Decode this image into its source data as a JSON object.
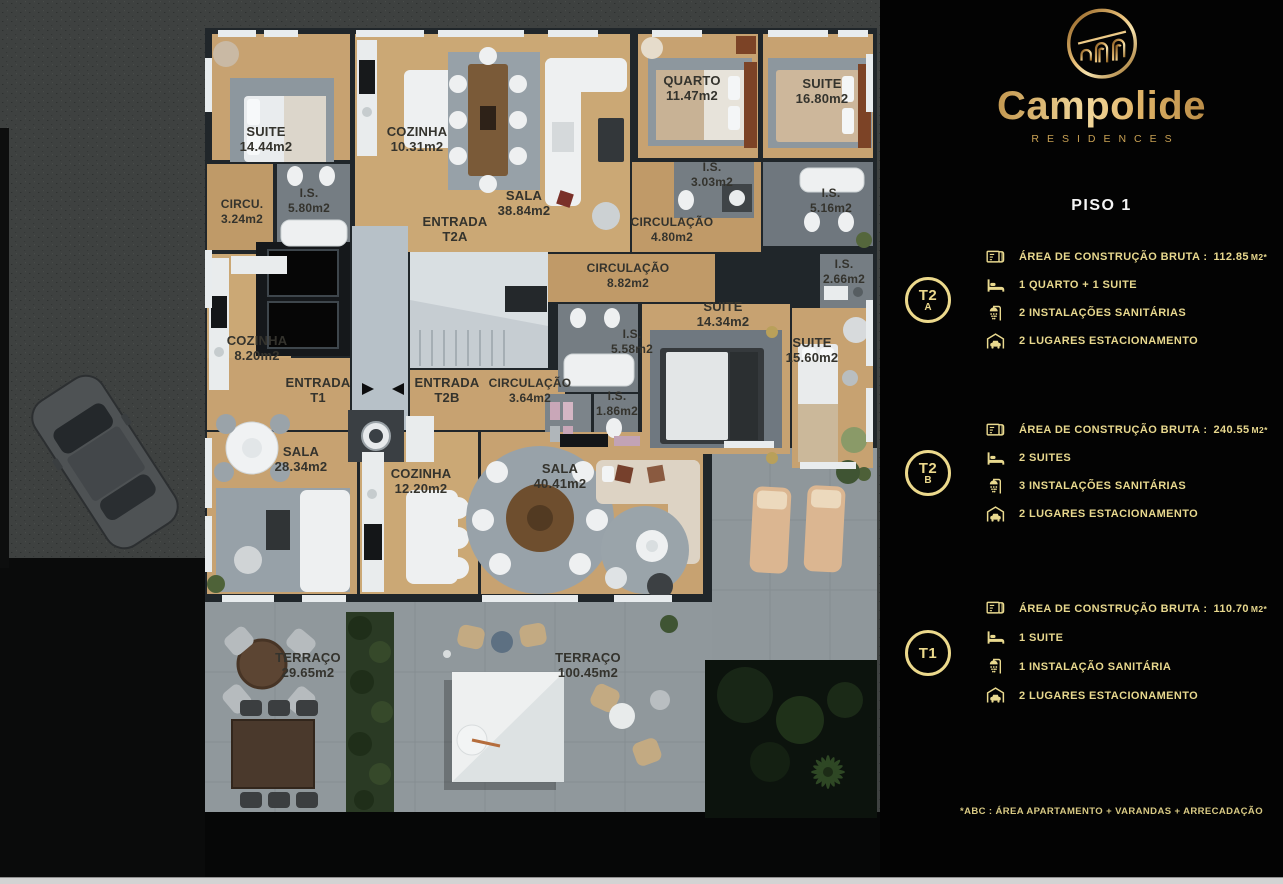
{
  "plan": {
    "rooms": [
      {
        "name": "SUITE",
        "area": "14.44m2"
      },
      {
        "name": "COZINHA",
        "area": "10.31m2"
      },
      {
        "name": "SALA",
        "area": "38.84m2"
      },
      {
        "name": "I.S.",
        "area": "5.80m2"
      },
      {
        "name": "CIRCU.",
        "area": "3.24m2"
      },
      {
        "name": "ENTRADA",
        "area": "T2A"
      },
      {
        "name": "CIRCULAÇÃO",
        "area": "4.80m2"
      },
      {
        "name": "QUARTO",
        "area": "11.47m2"
      },
      {
        "name": "SUITE",
        "area": "16.80m2"
      },
      {
        "name": "I.S.",
        "area": "3.03m2"
      },
      {
        "name": "I.S.",
        "area": "5.16m2"
      },
      {
        "name": "CIRCULAÇÃO",
        "area": "8.82m2"
      },
      {
        "name": "I.S.",
        "area": "2.66m2"
      },
      {
        "name": "SUITE",
        "area": "14.34m2"
      },
      {
        "name": "I.S.",
        "area": "5.58m2"
      },
      {
        "name": "SUITE",
        "area": "15.60m2"
      },
      {
        "name": "I.S.",
        "area": "1.86m2"
      },
      {
        "name": "COZINHA",
        "area": "8.20m2"
      },
      {
        "name": "ENTRADA",
        "area": "T1"
      },
      {
        "name": "ENTRADA",
        "area": "T2B"
      },
      {
        "name": "CIRCULAÇÃO",
        "area": "3.64m2"
      },
      {
        "name": "SALA",
        "area": "28.34m2"
      },
      {
        "name": "COZINHA",
        "area": "12.20m2"
      },
      {
        "name": "SALA",
        "area": "40.41m2"
      },
      {
        "name": "TERRAÇO",
        "area": "29.65m2"
      },
      {
        "name": "TERRAÇO",
        "area": "100.45m2"
      }
    ]
  },
  "panel": {
    "brand": "Campolide",
    "brand_sub": "RESIDENCES",
    "floor_title": "PISO 1",
    "units": [
      {
        "badge_line1": "T2",
        "badge_line2": "A",
        "area_label": "ÁREA DE CONSTRUÇÃO BRUTA :",
        "area_value": "112.85",
        "area_unit": "M2*",
        "features": [
          "1 QUARTO + 1 SUITE",
          "2 INSTALAÇÕES SANITÁRIAS",
          "2 LUGARES ESTACIONAMENTO"
        ]
      },
      {
        "badge_line1": "T2",
        "badge_line2": "B",
        "area_label": "ÁREA DE CONSTRUÇÃO BRUTA :",
        "area_value": "240.55",
        "area_unit": "M2*",
        "features": [
          "2 SUITES",
          "3 INSTALAÇÕES SANITÁRIAS",
          "2 LUGARES ESTACIONAMENTO"
        ]
      },
      {
        "badge_line1": "T1",
        "badge_line2": "",
        "area_label": "ÁREA DE CONSTRUÇÃO BRUTA :",
        "area_value": "110.70",
        "area_unit": "M2*",
        "features": [
          "1 SUITE",
          "1 INSTALAÇÃO SANITÁRIA",
          "2 LUGARES ESTACIONAMENTO"
        ]
      }
    ],
    "footnote": "*ABC :  ÁREA APARTAMENTO + VARANDAS + ARRECADAÇÃO",
    "colors": {
      "gold": "#e8d88e",
      "gold_dark": "#b9862f",
      "panel_bg": "#030303"
    }
  }
}
